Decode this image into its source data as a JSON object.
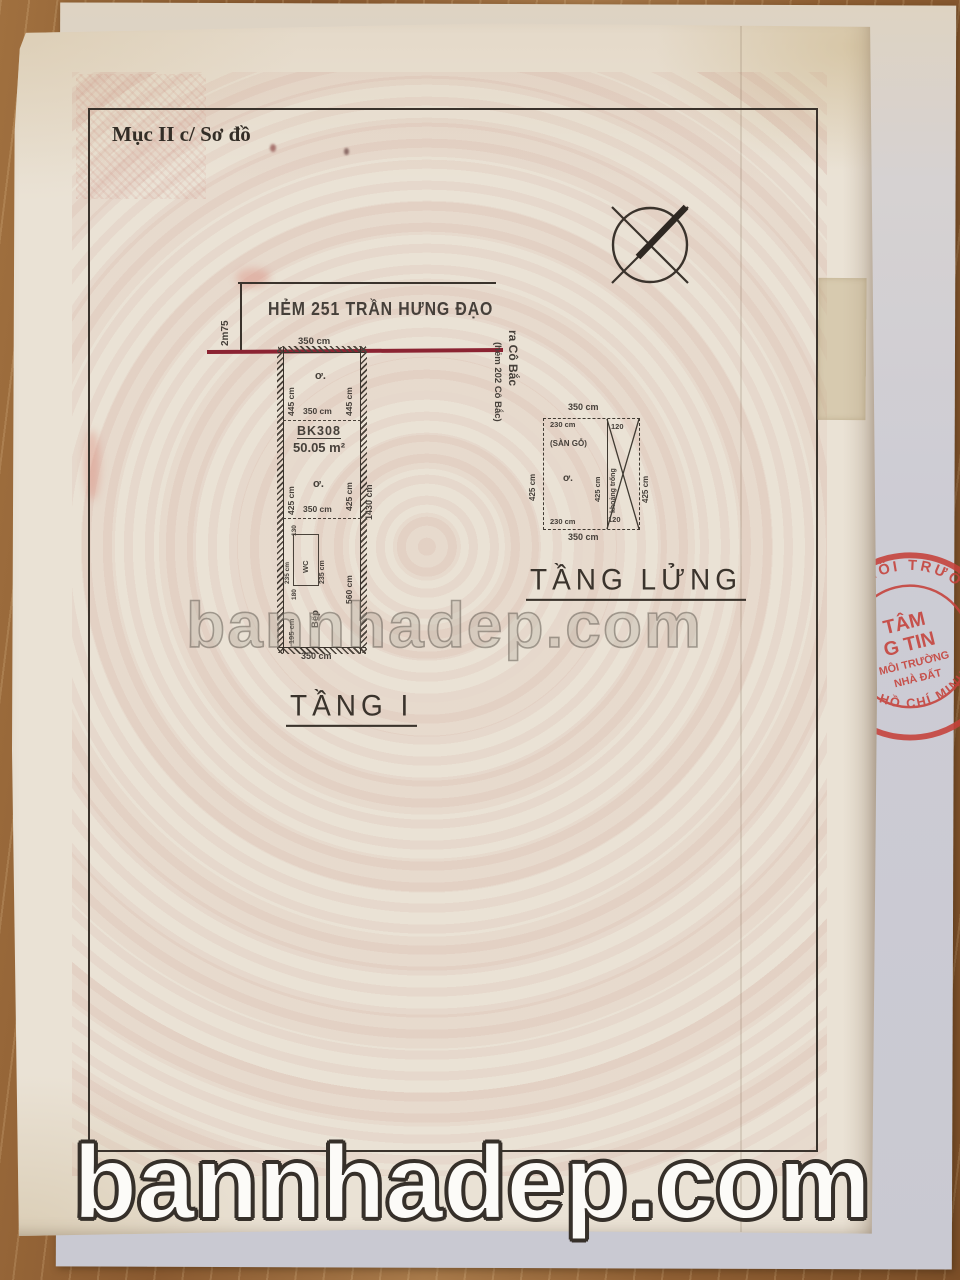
{
  "page": {
    "section_header": "Mục II c/ Sơ đồ"
  },
  "street": {
    "name": "HẺM 251 TRẦN HƯNG ĐẠO",
    "alley_width": "2m75",
    "side_note_1": "ra Cô Bắc",
    "side_note_2": "(hẻm 202 Cô Bắc)"
  },
  "floor1": {
    "title": "TẦNG I",
    "parcel_code": "BK308",
    "area": "50.05 m²",
    "room_top_label": "ơ.",
    "room_mid_label": "ơ.",
    "dim_frontage": "350 cm",
    "dim_top_left": "445 cm",
    "dim_top_right": "445 cm",
    "dim_divider1": "350 cm",
    "dim_mid_left": "425 cm",
    "dim_mid_right": "425 cm",
    "dim_total_right": "1430 cm",
    "dim_divider2": "350 cm",
    "wc_label": "WC",
    "dim_wc_width": "130",
    "dim_wc_height": "235 cm",
    "dim_wc_side": "235 cm",
    "dim_wc_below": "180",
    "kitchen_label": "Bếp",
    "dim_kitchen_left": "195 cm",
    "dim_lower_right": "560 cm",
    "dim_bottom": "350 cm"
  },
  "mezzanine": {
    "title": "TẦNG LỬNG",
    "wood_floor_label": "(SÀN GỖ)",
    "room_label": "ơ.",
    "void_label": "khoảng trống",
    "dim_top": "350 cm",
    "dim_top_left": "230 cm",
    "dim_top_right": "120",
    "dim_left": "425 cm",
    "dim_mid": "425 cm",
    "dim_right": "425 cm",
    "dim_bottom_left": "230 cm",
    "dim_bottom_right": "120",
    "dim_bottom": "350 cm"
  },
  "stamp": {
    "arc_top": "Ả MÔI TRƯỜNG",
    "line1": "TÂM",
    "line2": "G TIN",
    "line3": "MÔI TRƯỜNG",
    "line4": "NHÀ ĐẤT",
    "arc_bottom": "HỒ CHÍ MINH",
    "star": "✱",
    "color": "#c6413a"
  },
  "watermarks": {
    "center": "bannhadep.com",
    "bottom": "bannhadep.com"
  },
  "colors": {
    "boundary_red": "#8b2332",
    "stamp_red": "#c6413a",
    "ink": "#3f3931"
  }
}
